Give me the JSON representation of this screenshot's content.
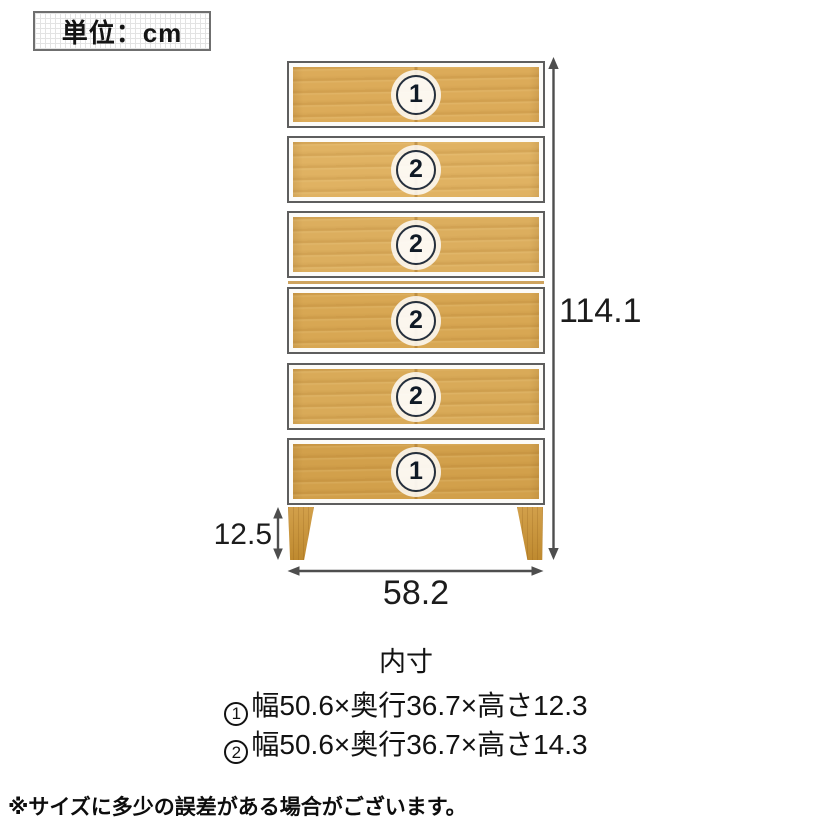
{
  "unit_box": {
    "label": "単位：cm"
  },
  "diagram": {
    "drawers": [
      {
        "badge": "1"
      },
      {
        "badge": "2"
      },
      {
        "badge": "2"
      },
      {
        "badge": "2"
      },
      {
        "badge": "2"
      },
      {
        "badge": "1"
      }
    ],
    "dimensions": {
      "total_height": "114.1",
      "leg_height": "12.5",
      "width": "58.2"
    }
  },
  "inner_dimensions": {
    "title": "内寸",
    "rows": [
      {
        "badge": "1",
        "text": "幅50.6×奥行36.7×高さ12.3"
      },
      {
        "badge": "2",
        "text": "幅50.6×奥行36.7×高さ14.3"
      }
    ]
  },
  "footnote": "※サイズに多少の誤差がある場合がございます。",
  "colors": {
    "wood_base": "#dcab59",
    "wood_dark": "#bf8a2f",
    "dimension_line": "#4e4e4e",
    "badge_ring": "#25303f",
    "text": "#111111"
  }
}
